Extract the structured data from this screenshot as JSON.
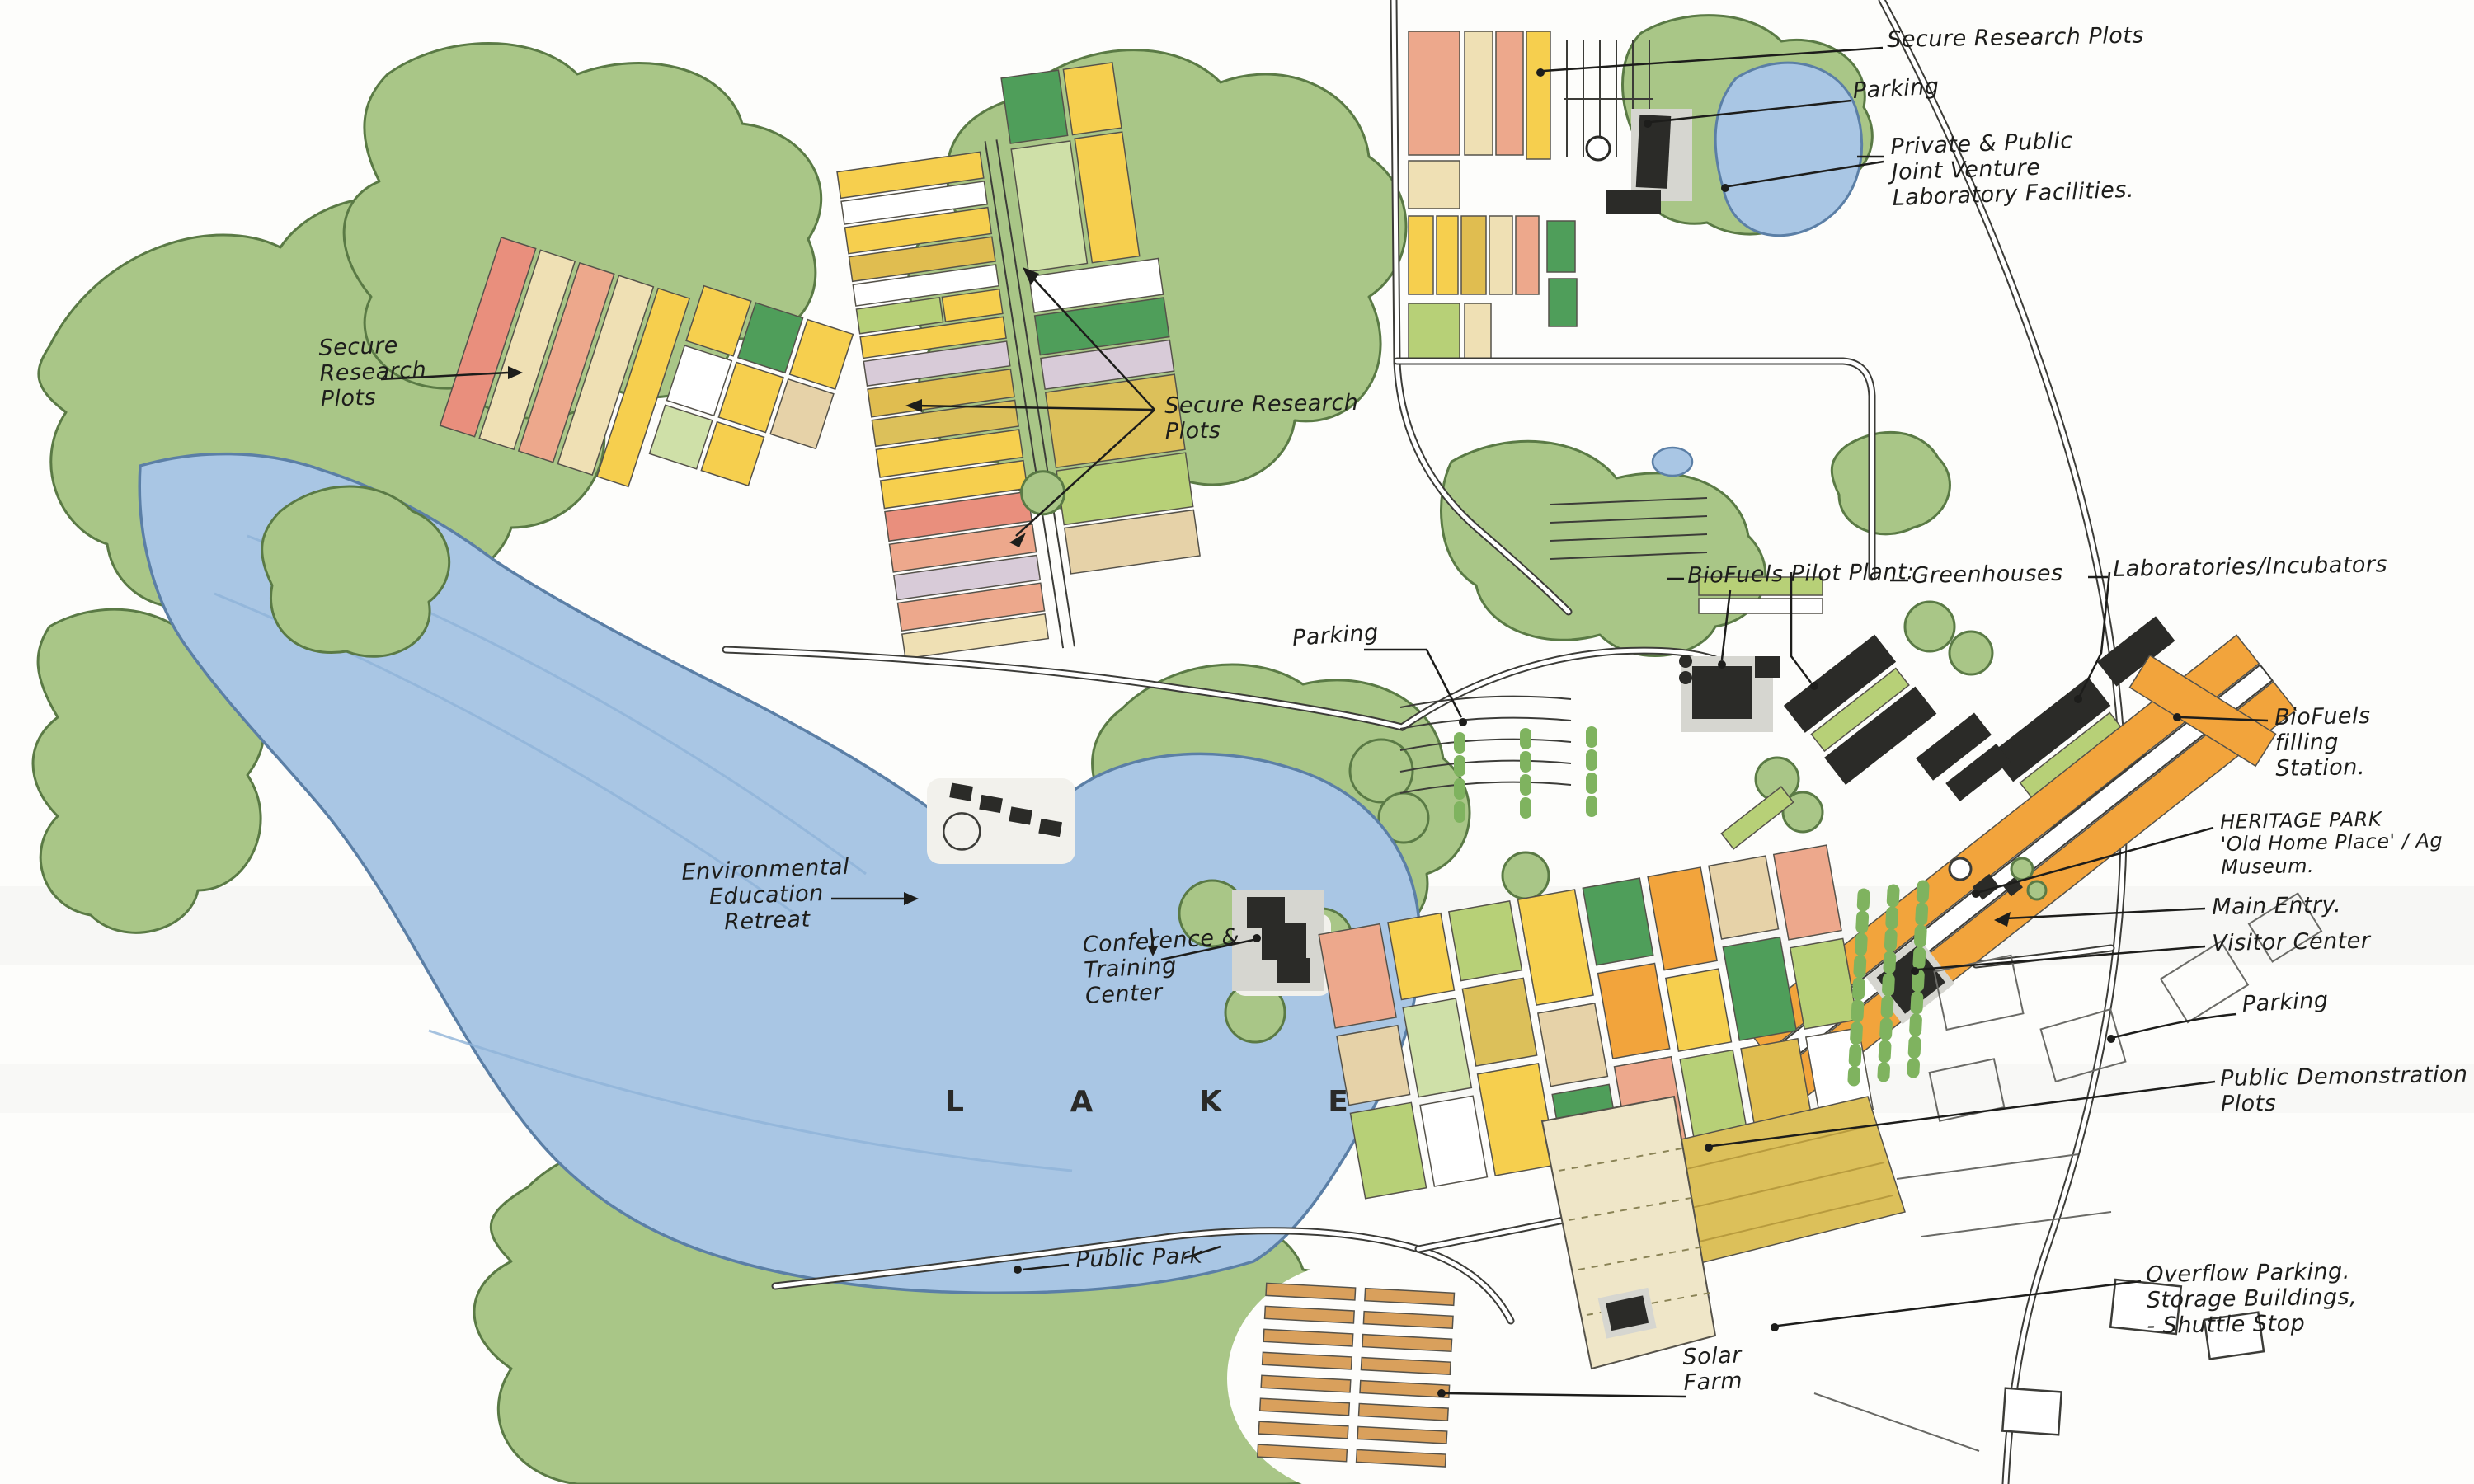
{
  "annotations": {
    "secure_research_plots_left": {
      "lines": [
        "Secure",
        "Research",
        "Plots"
      ]
    },
    "secure_research_plots_center": {
      "lines": [
        "Secure Research",
        "Plots"
      ]
    },
    "secure_research_plots_top": {
      "lines": [
        "Secure Research Plots"
      ]
    },
    "parking_top": {
      "lines": [
        "Parking"
      ]
    },
    "private_public_jv": {
      "lines": [
        "Private & Public",
        "Joint Venture",
        "Laboratory Facilities."
      ]
    },
    "biofuels_pilot_plant": {
      "lines": [
        "BioFuels Pilot Plant:"
      ]
    },
    "greenhouses": {
      "lines": [
        "Greenhouses"
      ]
    },
    "laboratories_incubators": {
      "lines": [
        "Laboratories/Incubators"
      ]
    },
    "parking_center": {
      "lines": [
        "Parking"
      ]
    },
    "biofuels_filling_station": {
      "lines": [
        "BioFuels",
        "filling",
        "Station."
      ]
    },
    "heritage_park": {
      "lines": [
        "HERITAGE PARK",
        "'Old Home Place' / Ag Museum."
      ]
    },
    "main_entry": {
      "lines": [
        "Main Entry."
      ]
    },
    "visitor_center": {
      "lines": [
        "Visitor Center"
      ]
    },
    "parking_right": {
      "lines": [
        "Parking"
      ]
    },
    "public_demonstration_plots": {
      "lines": [
        "Public Demonstration",
        "Plots"
      ]
    },
    "overflow_parking": {
      "lines": [
        "Overflow Parking.",
        "Storage Buildings,",
        "- Shuttle Stop"
      ]
    },
    "solar_farm": {
      "lines": [
        "Solar",
        "Farm"
      ]
    },
    "environmental_education_retreat": {
      "lines": [
        "Environmental",
        "Education",
        "Retreat"
      ]
    },
    "conference_training_center": {
      "lines": [
        "Conference &",
        "Training",
        "Center"
      ]
    },
    "lake": {
      "lines": [
        "L A K E"
      ]
    },
    "public_park": {
      "lines": [
        "Public Park"
      ]
    }
  },
  "colors": {
    "ink": "#1d1d1b",
    "road-line": "#3c3c38",
    "tree-green": "#a9c687",
    "tree-outline": "#5a7a45",
    "lake-blue": "#a9c6e4",
    "lake-outline": "#5b7fa6",
    "building-dark": "#2b2b28",
    "plot-yellow": "#f6cf4e",
    "plot-gold": "#e0bd50",
    "plot-gold2": "#dcc05a",
    "plot-salmon": "#eda88c",
    "plot-red": "#e98f7d",
    "plot-cream": "#efe0b4",
    "plot-tan": "#e6d2a8",
    "plot-lavender": "#d8cbd8",
    "plot-ltgreen": "#b7d077",
    "plot-palegreen": "#cfe0a8",
    "plot-green": "#4f9e5a",
    "plot-orange": "#f2a43c",
    "solar-strip": "#d9a05c"
  }
}
